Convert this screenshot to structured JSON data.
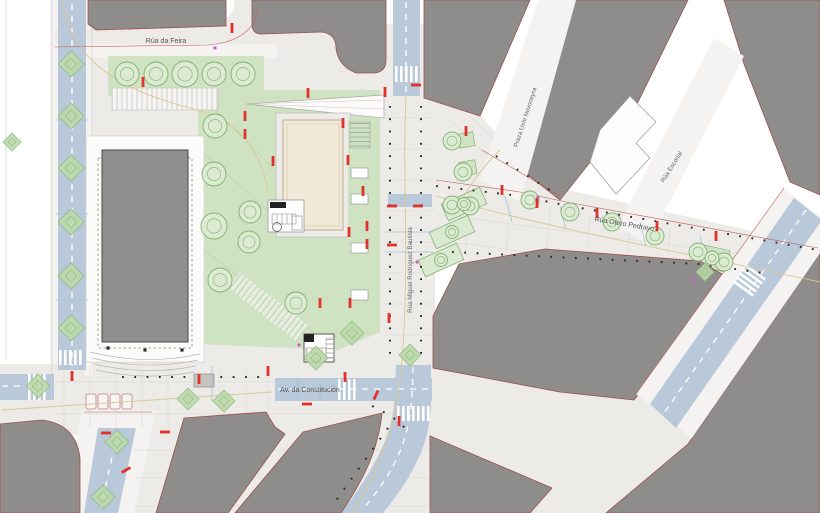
{
  "plan": {
    "labels": {
      "rua_da_feira": "Rúa da Feira",
      "av_constitucion": "Av. da Constitución",
      "rua_miguel": "Rúa Miguel Rodríguez Bautista",
      "rua_otero": "Rúa Otero Pedrayo",
      "praza_uxio": "Praza Uxío Novoneyra",
      "rua_escorial": "Rúa Escorial"
    },
    "colors": {
      "building": "#8e8d8c",
      "building_outline": "#9a4f4a",
      "road_blue": "#b9c9da",
      "street_gray": "#ecebe8",
      "sidewalk": "#f4f3f1",
      "green": "#cfe3c2",
      "green_dark": "#7dae6c",
      "beige": "#f2e9d9",
      "red_mark": "#e0312c",
      "tan_line": "#d9c691",
      "util_blue": "#9fc3d8",
      "magenta": "#c95fc2"
    }
  }
}
